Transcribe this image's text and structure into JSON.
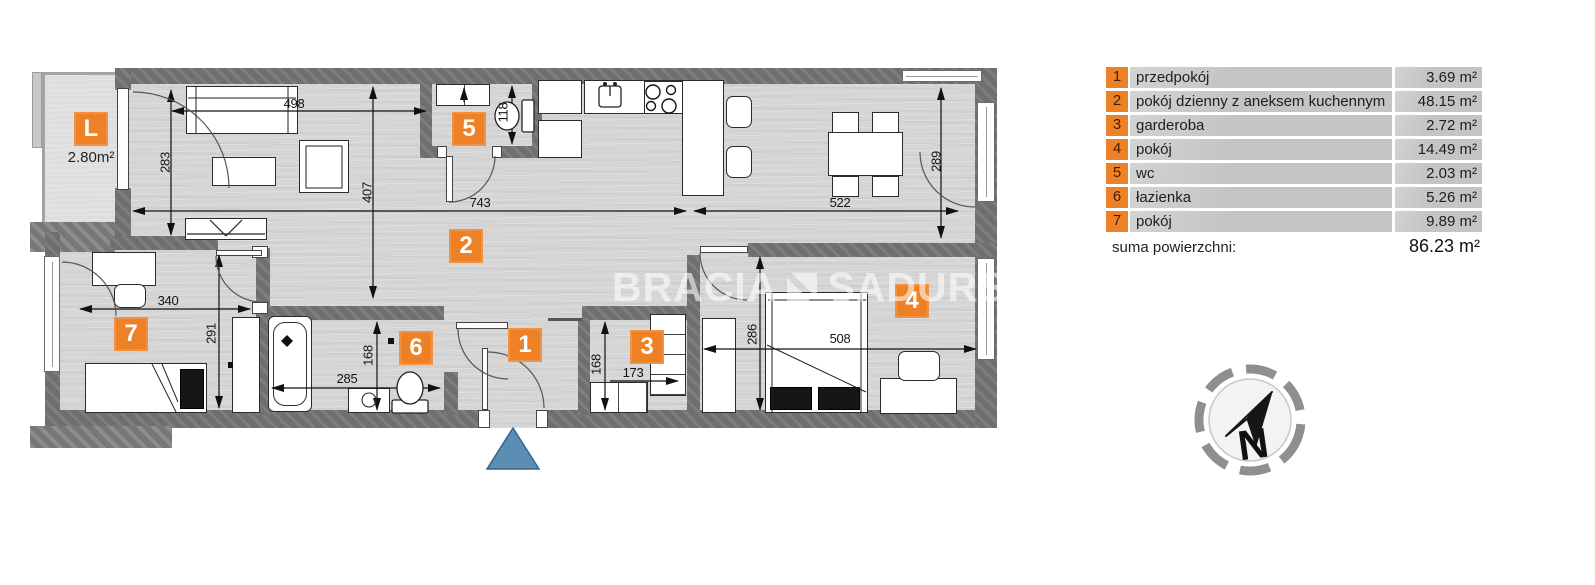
{
  "plan": {
    "balcony": {
      "label": "L",
      "area": "2.80m²"
    },
    "rooms": {
      "r1": "1",
      "r2": "2",
      "r3": "3",
      "r4": "4",
      "r5": "5",
      "r6": "6",
      "r7": "7"
    },
    "dims": {
      "sofa_wall": "498",
      "living_left": "283",
      "living_depth": "407",
      "living_width": "743",
      "dining_width": "522",
      "dining_depth": "289",
      "wc_width": "118",
      "room7_width": "340",
      "room7_depth": "291",
      "bath_width": "285",
      "bath_depth": "168",
      "ward_depth": "168",
      "ward_width": "173",
      "room4_depth": "286",
      "room4_width": "508"
    }
  },
  "watermark": {
    "left": "BRACIA",
    "right": "SADURSCY"
  },
  "legend": {
    "rows": [
      {
        "num": "1",
        "name": "przedpokój",
        "area": "3.69 m²"
      },
      {
        "num": "2",
        "name": "pokój dzienny z aneksem kuchennym",
        "area": "48.15 m²"
      },
      {
        "num": "3",
        "name": "garderoba",
        "area": "2.72 m²"
      },
      {
        "num": "4",
        "name": "pokój",
        "area": "14.49 m²"
      },
      {
        "num": "5",
        "name": "wc",
        "area": "2.03 m²"
      },
      {
        "num": "6",
        "name": "łazienka",
        "area": "5.26 m²"
      },
      {
        "num": "7",
        "name": "pokój",
        "area": "9.89 m²"
      }
    ],
    "total_label": "suma powierzchni:",
    "total_value": "86.23 m²"
  },
  "compass": {
    "north": "N"
  },
  "colors": {
    "accent": "#ee8125",
    "wall": "#6f6f6f",
    "floor": "#d5d5d5",
    "entrance": "#5c8eb3"
  }
}
